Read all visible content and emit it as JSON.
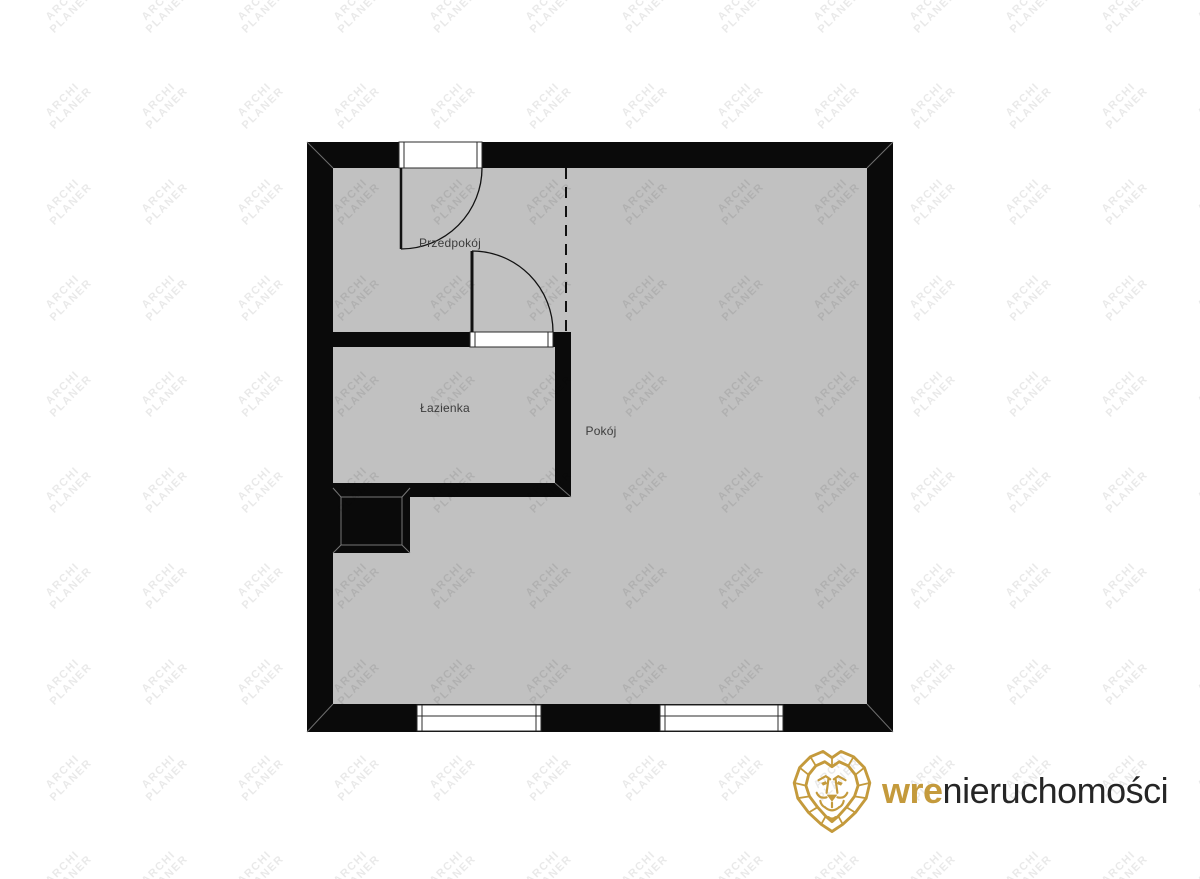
{
  "watermark": {
    "line1": "ARCHI",
    "line2": "PLANER",
    "color": "rgba(0,0,0,0.085)"
  },
  "floorplan": {
    "rooms": [
      {
        "id": "przedpokoj",
        "label": "Przedpokój"
      },
      {
        "id": "lazienka",
        "label": "Łazienka"
      },
      {
        "id": "pokoj",
        "label": "Pokój"
      }
    ],
    "elements": {
      "entrance_door": "door-swing-top",
      "bathroom_door": "door-swing-interior",
      "windows": 2,
      "partition": "dashed-virtual-boundary",
      "shaft": "installation-shaft"
    },
    "colors": {
      "floor": "#c1c1c1",
      "wall": "#0a0a0a",
      "opening": "#ffffff",
      "label_text": "#3c3c3c"
    }
  },
  "logo": {
    "icon": "lion-icon",
    "brand_bold": "wre",
    "brand_rest": "nieruchomości",
    "gold": "#c49a3c",
    "text_color": "#262626"
  }
}
